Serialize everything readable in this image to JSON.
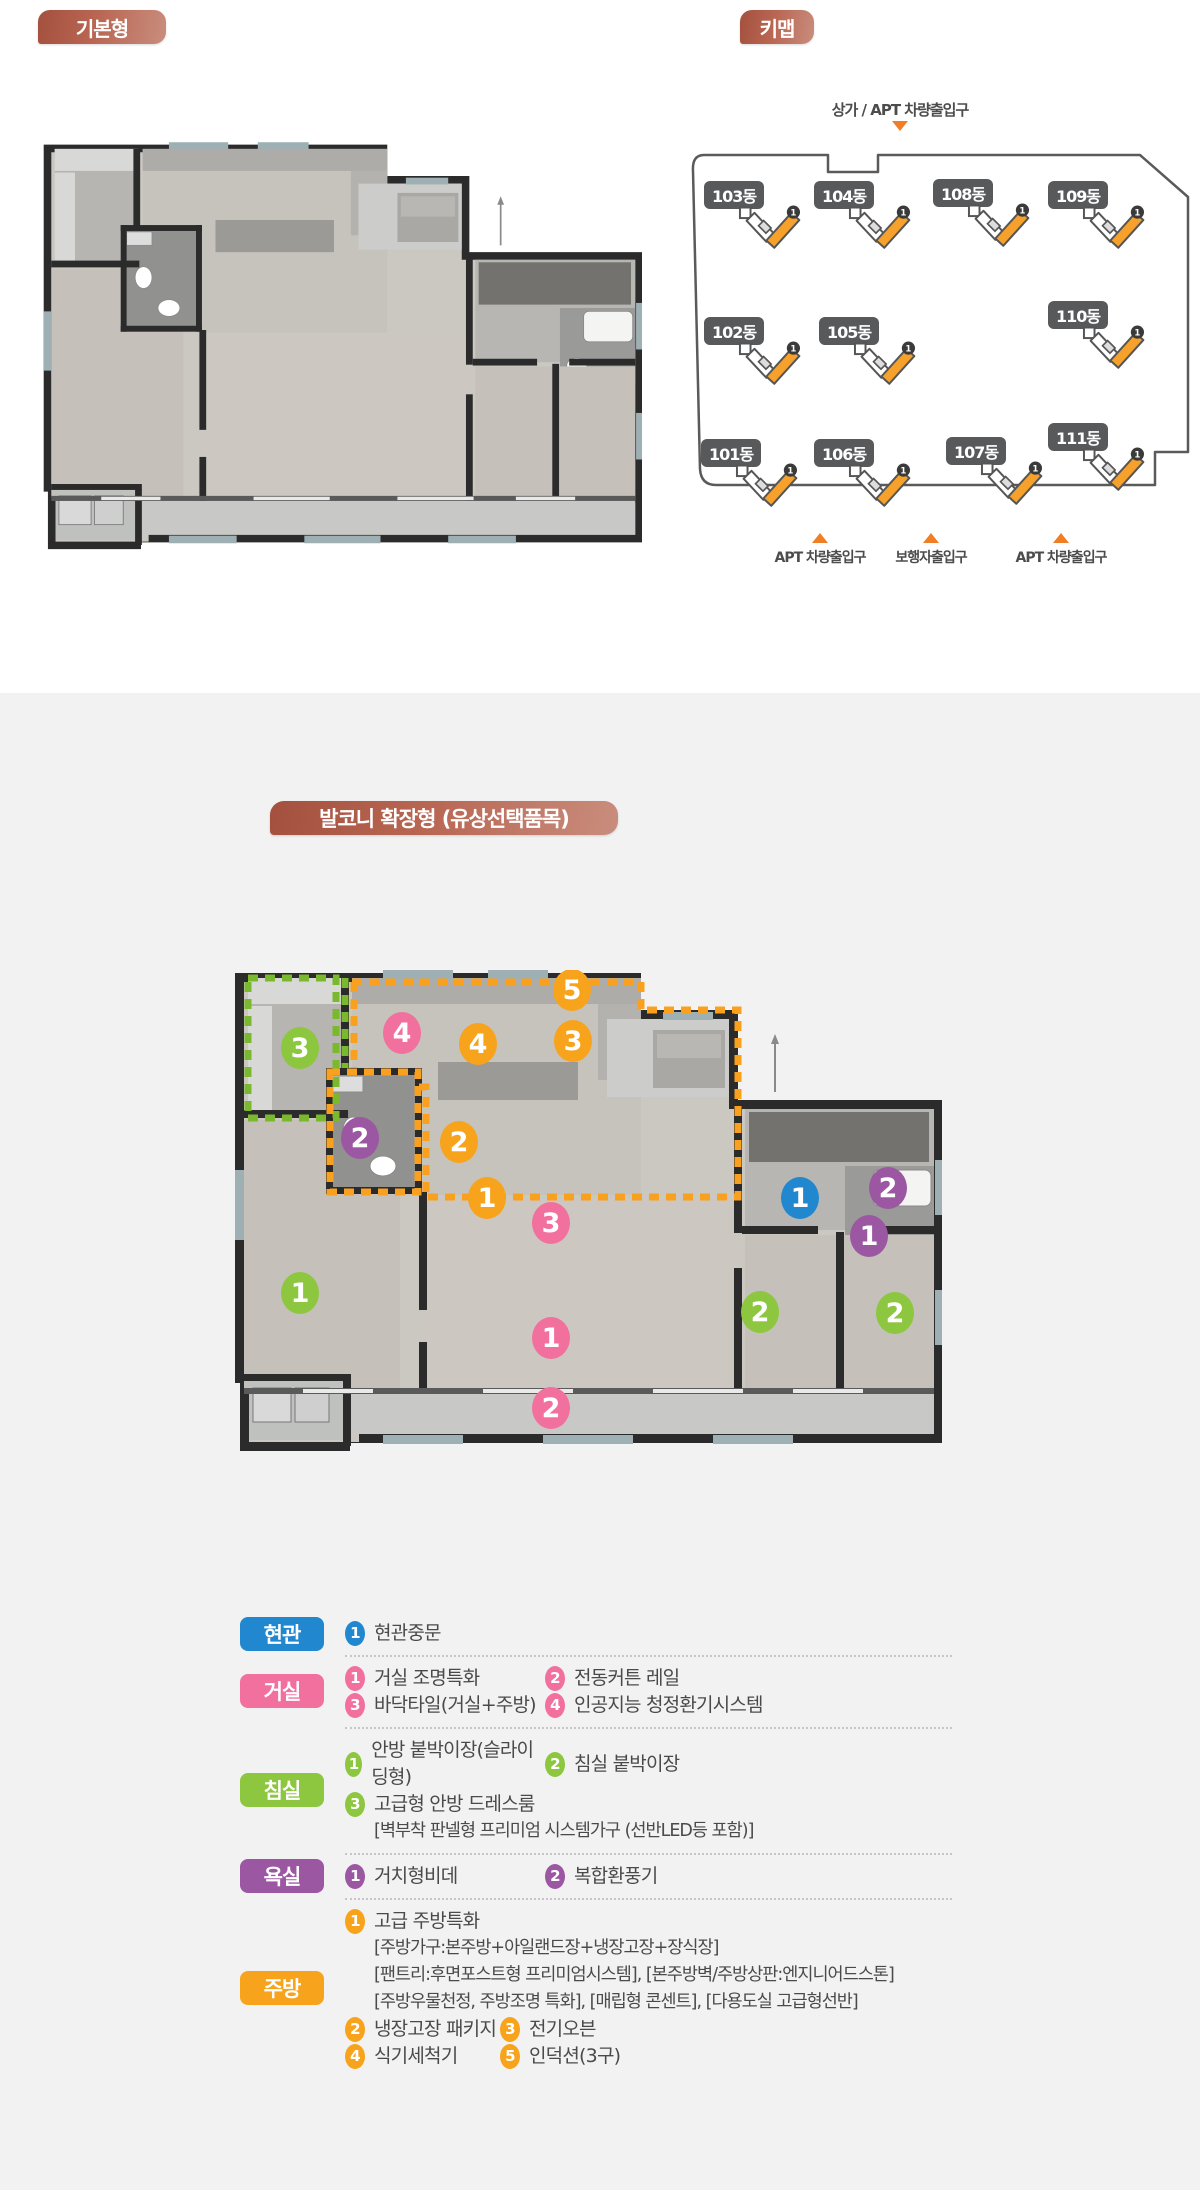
{
  "page": {
    "background": "#ffffff",
    "panel_background": "#f2f2f2"
  },
  "colors": {
    "brown_badge": "#b05a46",
    "orange": "#f8a31c",
    "pink": "#f2709d",
    "green": "#8dc63f",
    "purple": "#9c57a3",
    "blue": "#2187ce",
    "building_badge": "#58595b",
    "arrow_orange": "#f07e26",
    "text": "#4a4a4a"
  },
  "header": {
    "basic_label": "기본형",
    "keymap_label": "키맵"
  },
  "balcony_section": {
    "title": "발코니 확장형 (유상선택품목)"
  },
  "keymap": {
    "top_entrance_label": "상가 / APT 차량출입구",
    "buildings": [
      {
        "label": "103동",
        "x": 16,
        "y": 86
      },
      {
        "label": "104동",
        "x": 126,
        "y": 86
      },
      {
        "label": "108동",
        "x": 245,
        "y": 84
      },
      {
        "label": "109동",
        "x": 360,
        "y": 86
      },
      {
        "label": "102동",
        "x": 16,
        "y": 222
      },
      {
        "label": "105동",
        "x": 131,
        "y": 222
      },
      {
        "label": "110동",
        "x": 360,
        "y": 206
      },
      {
        "label": "101동",
        "x": 13,
        "y": 344
      },
      {
        "label": "106동",
        "x": 126,
        "y": 344
      },
      {
        "label": "107동",
        "x": 258,
        "y": 342
      },
      {
        "label": "111동",
        "x": 360,
        "y": 328
      }
    ],
    "bottom_labels": [
      {
        "text": "APT 차량출입구",
        "x": 132
      },
      {
        "text": "보행자출입구",
        "x": 243
      },
      {
        "text": "APT 차량출입구",
        "x": 373
      }
    ]
  },
  "plan_markers": [
    {
      "x": 339,
      "y": 20,
      "c": "orange",
      "n": "5"
    },
    {
      "x": 169,
      "y": 63,
      "c": "pink",
      "n": "4"
    },
    {
      "x": 245,
      "y": 74,
      "c": "orange",
      "n": "4"
    },
    {
      "x": 340,
      "y": 71,
      "c": "orange",
      "n": "3"
    },
    {
      "x": 67,
      "y": 78,
      "c": "green",
      "n": "3"
    },
    {
      "x": 127,
      "y": 168,
      "c": "purple",
      "n": "2"
    },
    {
      "x": 226,
      "y": 172,
      "c": "orange",
      "n": "2"
    },
    {
      "x": 254,
      "y": 228,
      "c": "orange",
      "n": "1"
    },
    {
      "x": 318,
      "y": 253,
      "c": "pink",
      "n": "3"
    },
    {
      "x": 567,
      "y": 228,
      "c": "blue",
      "n": "1"
    },
    {
      "x": 655,
      "y": 218,
      "c": "purple",
      "n": "2"
    },
    {
      "x": 636,
      "y": 266,
      "c": "purple",
      "n": "1"
    },
    {
      "x": 67,
      "y": 323,
      "c": "green",
      "n": "1"
    },
    {
      "x": 527,
      "y": 342,
      "c": "green",
      "n": "2"
    },
    {
      "x": 662,
      "y": 343,
      "c": "green",
      "n": "2"
    },
    {
      "x": 318,
      "y": 368,
      "c": "pink",
      "n": "1"
    },
    {
      "x": 318,
      "y": 438,
      "c": "pink",
      "n": "2"
    }
  ],
  "legend": {
    "sections": [
      {
        "id": "hyeongwan",
        "label": "현관",
        "color": "blue",
        "rows": [
          [
            {
              "n": "1",
              "t": "현관중문"
            }
          ]
        ]
      },
      {
        "id": "geosil",
        "label": "거실",
        "color": "pink",
        "rows": [
          [
            {
              "n": "1",
              "t": "거실 조명특화"
            },
            {
              "n": "2",
              "t": "전동커튼 레일"
            }
          ],
          [
            {
              "n": "3",
              "t": "바닥타일(거실+주방)"
            },
            {
              "n": "4",
              "t": "인공지능 청정환기시스템"
            }
          ]
        ]
      },
      {
        "id": "chimsil",
        "label": "침실",
        "color": "green",
        "rows": [
          [
            {
              "n": "1",
              "t": "안방 붙박이장(슬라이딩형)"
            },
            {
              "n": "2",
              "t": "침실 붙박이장"
            }
          ],
          [
            {
              "n": "3",
              "t": "고급형 안방 드레스룸"
            }
          ],
          [
            {
              "note": "[벽부착 판넬형 프리미엄 시스템가구 (선반LED등 포함)]"
            }
          ]
        ]
      },
      {
        "id": "yoksil",
        "label": "욕실",
        "color": "purple",
        "rows": [
          [
            {
              "n": "1",
              "t": "거치형비데"
            },
            {
              "n": "2",
              "t": "복합환풍기"
            }
          ]
        ]
      },
      {
        "id": "jubang",
        "label": "주방",
        "color": "orange",
        "rows": [
          [
            {
              "n": "1",
              "t": "고급 주방특화"
            }
          ],
          [
            {
              "note": "[주방가구:본주방+아일랜드장+냉장고장+장식장]"
            }
          ],
          [
            {
              "note": "[팬트리:후면포스트형 프리미엄시스템], [본주방벽/주방상판:엔지니어드스톤]"
            }
          ],
          [
            {
              "note": "[주방우물천정, 주방조명 특화], [매립형 콘센트], [다용도실 고급형선반]"
            }
          ],
          [
            {
              "n": "2",
              "t": "냉장고장 패키지"
            },
            {
              "n": "3",
              "t": "전기오븐"
            }
          ],
          [
            {
              "n": "4",
              "t": "식기세척기"
            },
            {
              "n": "5",
              "t": "인덕션(3구)"
            }
          ]
        ]
      }
    ]
  }
}
